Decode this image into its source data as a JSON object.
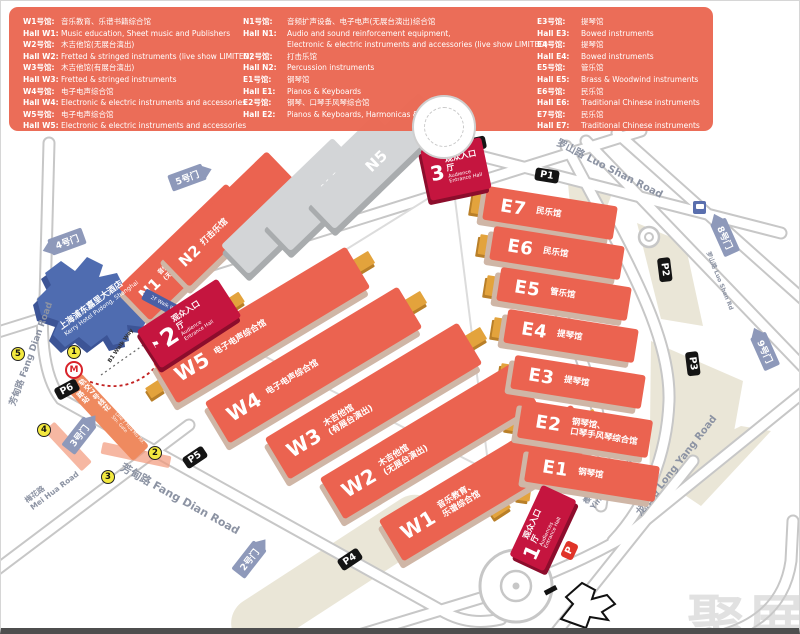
{
  "legend": {
    "c1": [
      {
        "l": "W1号馆:",
        "t": "音乐教育、乐谱书籍综合馆"
      },
      {
        "l": "Hall W1:",
        "t": "Music education, Sheet music and Publishers"
      },
      {
        "l": "W2号馆:",
        "t": "木吉他馆(无展台演出)"
      },
      {
        "l": "Hall W2:",
        "t": "Fretted & stringed instruments (live show LIMITED)"
      },
      {
        "l": "W3号馆:",
        "t": "木吉他馆(有展台演出)"
      },
      {
        "l": "Hall W3:",
        "t": "Fretted & stringed instruments"
      },
      {
        "l": "W4号馆:",
        "t": "电子电声综合馆"
      },
      {
        "l": "Hall W4:",
        "t": "Electronic & electric instruments and accessories"
      },
      {
        "l": "W5号馆:",
        "t": "电子电声综合馆"
      },
      {
        "l": "Hall W5:",
        "t": "Electronic & electric instruments and accessories"
      }
    ],
    "c2": [
      {
        "l": "N1号馆:",
        "t": "音频扩声设备、电子电声(无展台演出)综合馆"
      },
      {
        "l": "Hall N1:",
        "t": "Audio and sound reinforcement equipment,"
      },
      {
        "l": "",
        "t": "Electronic & electric instruments and accessories (live show LIMITED)"
      },
      {
        "l": "N2号馆:",
        "t": "打击乐馆"
      },
      {
        "l": "Hall N2:",
        "t": "Percussion instruments"
      },
      {
        "l": "E1号馆:",
        "t": "钢琴馆"
      },
      {
        "l": "Hall E1:",
        "t": "Pianos & Keyboards"
      },
      {
        "l": "E2号馆:",
        "t": "钢琴、口琴手风琴综合馆"
      },
      {
        "l": "Hall E2:",
        "t": "Pianos & Keyboards, Harmonicas & Accordions"
      }
    ],
    "c3": [
      {
        "l": "E3号馆:",
        "t": "提琴馆"
      },
      {
        "l": "Hall E3:",
        "t": "Bowed instruments"
      },
      {
        "l": "E4号馆:",
        "t": "提琴馆"
      },
      {
        "l": "Hall E4:",
        "t": "Bowed instruments"
      },
      {
        "l": "E5号馆:",
        "t": "管乐馆"
      },
      {
        "l": "Hall E5:",
        "t": "Brass & Woodwind instruments"
      },
      {
        "l": "E6号馆:",
        "t": "民乐馆"
      },
      {
        "l": "Hall E6:",
        "t": "Traditional Chinese instruments"
      },
      {
        "l": "E7号馆:",
        "t": "民乐馆"
      },
      {
        "l": "Hall E7:",
        "t": "Traditional Chinese instruments"
      }
    ]
  },
  "map": {
    "halls": {
      "w1": {
        "id": "W1",
        "name": "音乐教育、\n乐谱综合馆"
      },
      "w2": {
        "id": "W2",
        "name": "木吉他馆\n(无展台演出)"
      },
      "w3": {
        "id": "W3",
        "name": "木吉他馆\n(有展台演出)"
      },
      "w4": {
        "id": "W4",
        "name": "电子电声综合馆"
      },
      "w5": {
        "id": "W5",
        "name": "电子电声综合馆"
      },
      "n1": {
        "id": "N1",
        "name": "音频扩声设备、电子电声\n(无展台演出)综合馆"
      },
      "n2": {
        "id": "N2",
        "name": "打击乐馆"
      },
      "n3": {
        "id": "N3",
        "name": ""
      },
      "n4": {
        "id": "N4",
        "name": ""
      },
      "n5": {
        "id": "N5",
        "name": ""
      },
      "e1": {
        "id": "E1",
        "name": "钢琴馆"
      },
      "e2": {
        "id": "E2",
        "name": "钢琴馆、\n口琴手风琴综合馆"
      },
      "e3": {
        "id": "E3",
        "name": "提琴馆"
      },
      "e4": {
        "id": "E4",
        "name": "提琴馆"
      },
      "e5": {
        "id": "E5",
        "name": "管乐馆"
      },
      "e6": {
        "id": "E6",
        "name": "民乐馆"
      },
      "e7": {
        "id": "E7",
        "name": "民乐馆"
      }
    },
    "entrances": {
      "e1": {
        "num": "1",
        "zh": "观众入口厅",
        "en": "Audiences Entrance Hall"
      },
      "e2": {
        "num": "2",
        "zh": "观众入口厅",
        "en": "Audience Entrance Hall"
      },
      "e3": {
        "num": "3",
        "zh": "观众入口厅",
        "en": "Audience Entrance Hall"
      }
    },
    "gates": {
      "g2": "2号门",
      "g3": "3号门",
      "g4": "4号门",
      "g5": "5号门",
      "g8": "8号门",
      "g9": "9号门"
    },
    "parking": {
      "p1": "P1",
      "p2": "P2",
      "p3": "P3",
      "p4": "P4",
      "p5": "P5",
      "p6": "P6",
      "pb": "P",
      "pr": "P"
    },
    "roads": {
      "huamu": {
        "zh": "花木路",
        "en": "Hua Mu Road"
      },
      "luoshan": {
        "zh": "罗山路",
        "en": "Luo Shan Road"
      },
      "luoshan_s": {
        "zh": "罗山路",
        "en": "Luo Shan Rd"
      },
      "fangdian": {
        "zh": "芳甸路",
        "en": "Fang Dian Road"
      },
      "longyang": {
        "zh": "龙阳路",
        "en": "Long Yang Road"
      },
      "meihua": {
        "zh": "梅花路",
        "en": "Mei Hua Road"
      },
      "yinghua": {
        "zh": "樱花路",
        "en": "Ying Hua Road"
      }
    },
    "hotel": {
      "zh": "上海浦东嘉里大酒店",
      "en": "Kerry Hotel Pudong, Shanghai"
    },
    "walkways": {
      "f2": "2F Walk Way",
      "b1": "B1 Walk Way"
    },
    "metro": {
      "zh": "轨交7号线花木路站",
      "en": "Line 7 Hua Mu Rd. Stn. Gate"
    },
    "stops": {
      "s1": "1",
      "s2": "2",
      "s3": "3",
      "s4": "4",
      "s5": "5"
    },
    "icons": {
      "flag": "⚑",
      "metro": "M"
    }
  },
  "watermark": "聚展",
  "colors": {
    "legend_bg": "#EA6853",
    "hall_red": "#EB6350",
    "hall_gray": "#D3D5D7",
    "entrance_red": "#C5153F",
    "hotel_blue": "#4F6CB0",
    "gate_blue": "#8E99BA",
    "parking_black": "#141414",
    "parking_red": "#E03328",
    "connector_gold": "#E3A33C",
    "stop_yellow": "#F3E93F",
    "road_gray": "#C7C7C7",
    "metro_red": "#D8232A",
    "beige": "#EAE6D7"
  }
}
